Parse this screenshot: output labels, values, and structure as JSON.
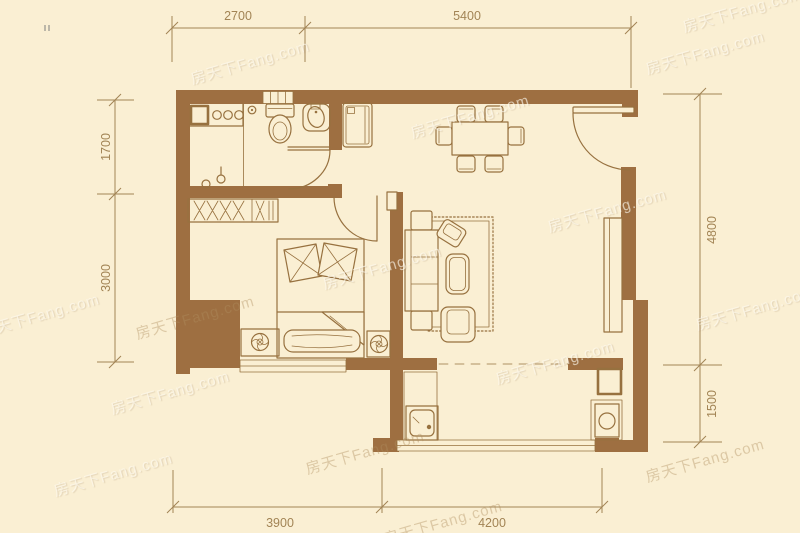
{
  "watermark": {
    "text": "房天下Fang.com"
  },
  "dimensions": {
    "top": [
      {
        "label": "2700"
      },
      {
        "label": "5400"
      }
    ],
    "left": [
      {
        "label": "1700"
      },
      {
        "label": "3000"
      }
    ],
    "right": [
      {
        "label": "4800"
      },
      {
        "label": "1500"
      }
    ],
    "bottom": [
      {
        "label": "3900"
      },
      {
        "label": "4200"
      }
    ]
  },
  "colors": {
    "background": "#faefd3",
    "wall": "#9e6f41",
    "furniture_line": "#97713f",
    "furniture_fill": "#fbf3dc",
    "dimension": "#a28455",
    "watermark_light": "rgba(255,252,242,0.62)",
    "watermark_dark": "rgba(176,142,95,0.40)"
  }
}
